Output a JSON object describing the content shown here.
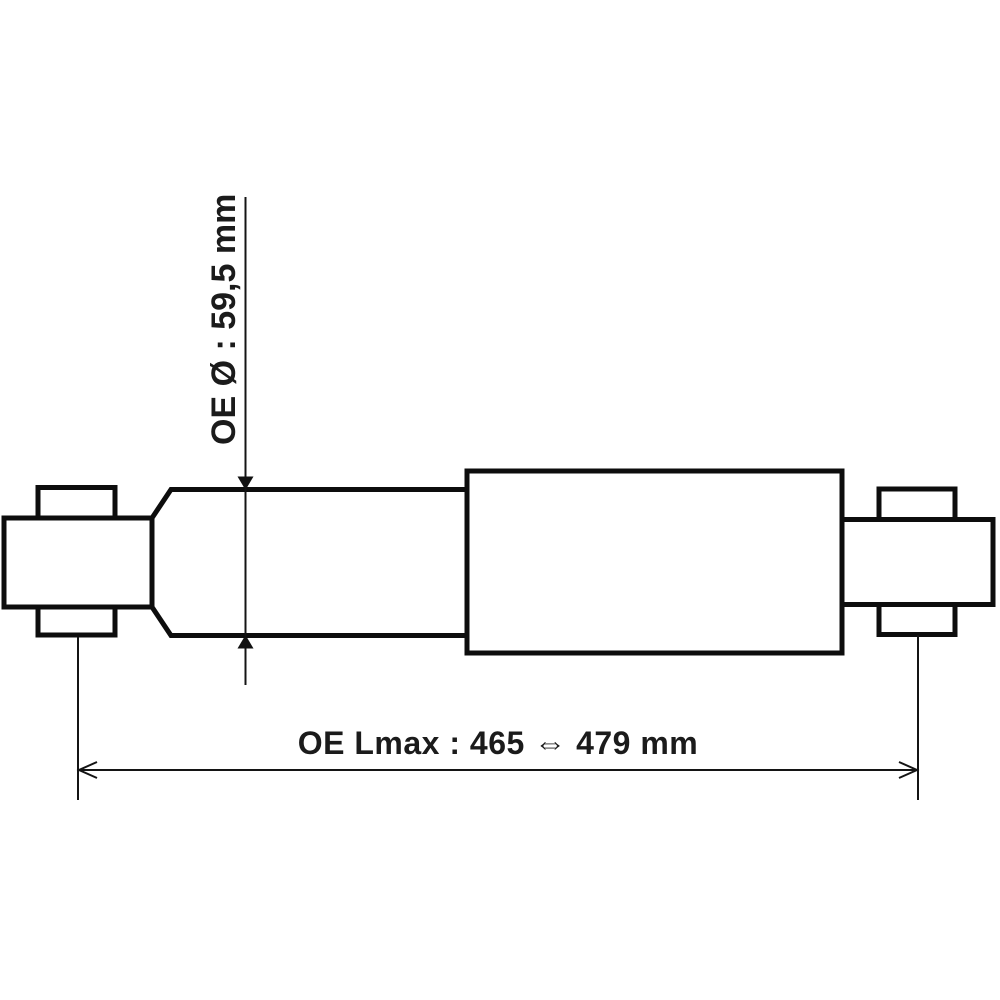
{
  "colors": {
    "background": "#ffffff",
    "line": "#0d0d0d",
    "text": "#1b1b1b"
  },
  "diagram": {
    "subject": "shock-absorber-side-view-technical-drawing",
    "dimensions": {
      "diameter": {
        "label": "OE Ø : 59,5 mm",
        "value": "59,5",
        "unit": "mm"
      },
      "length": {
        "label": "OE Lmax : 465 ⇔ 479 mm",
        "min": "465",
        "max": "479",
        "unit": "mm"
      }
    }
  }
}
